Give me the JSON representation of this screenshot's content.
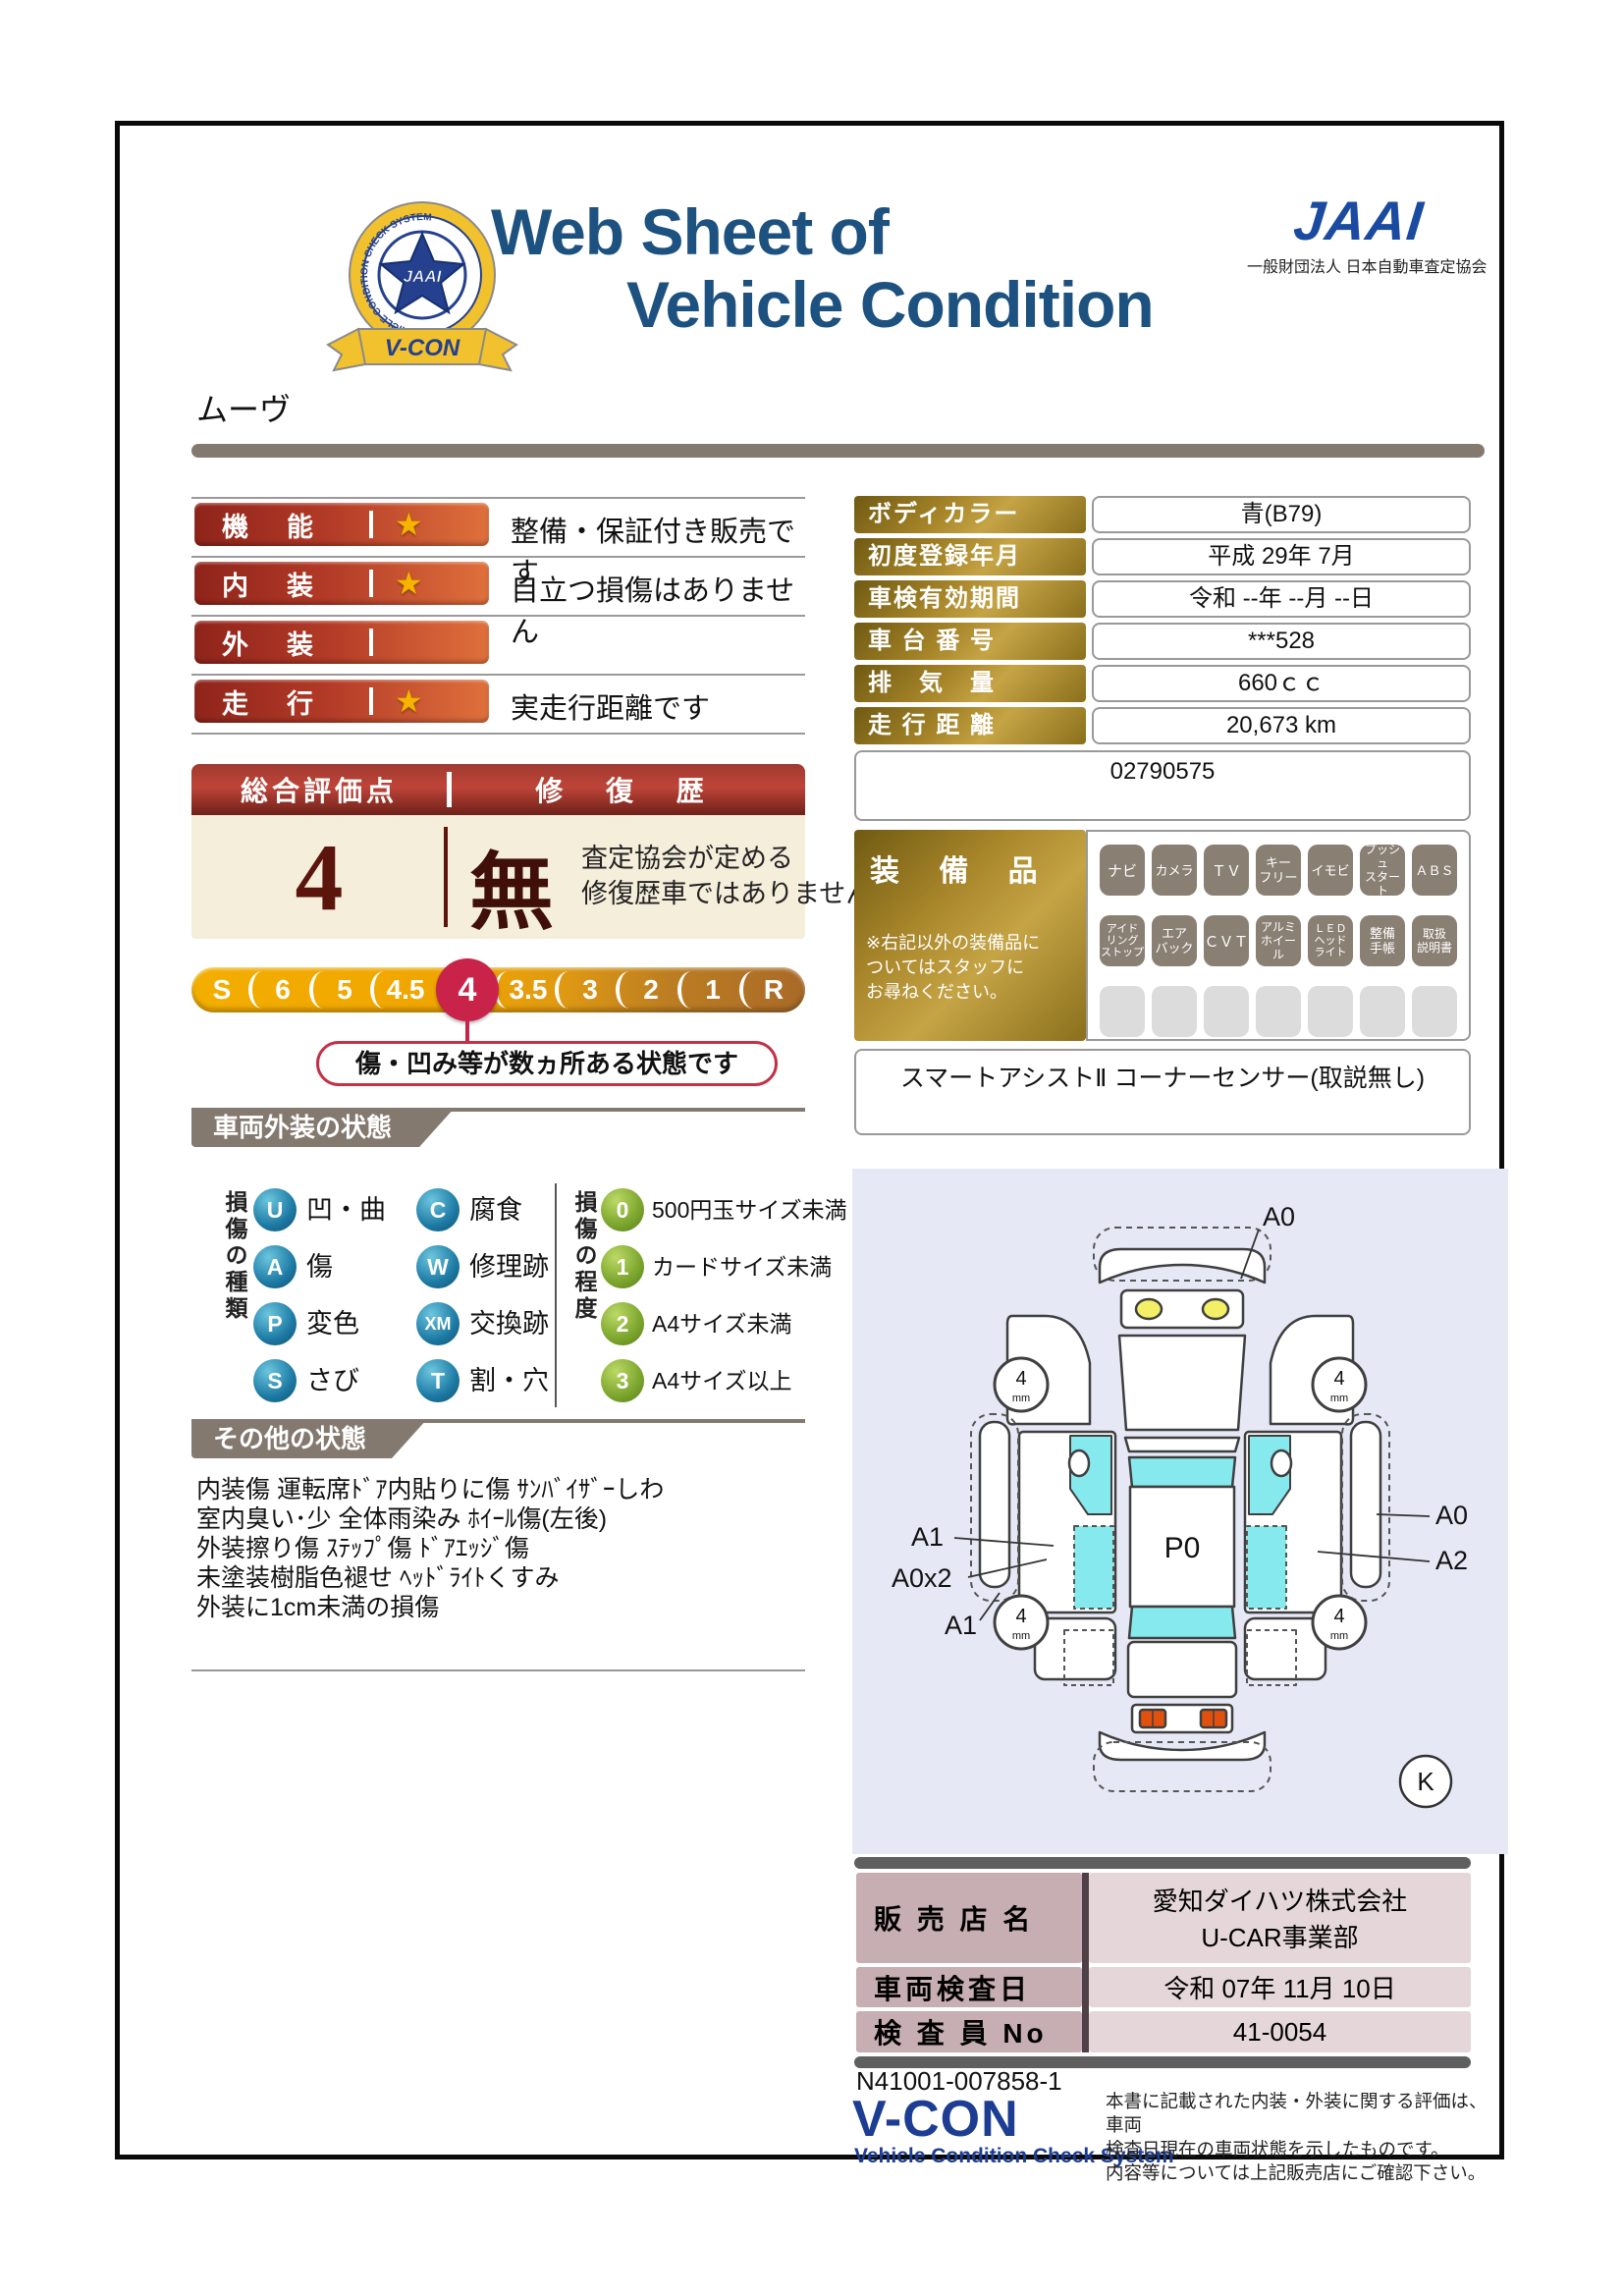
{
  "header": {
    "title_line1": "Web Sheet of",
    "title_line2": "Vehicle Condition",
    "jaai_logo": "JAAI",
    "jaai_subtitle": "一般財団法人 日本自動車査定協会",
    "emblem": {
      "center": "JAAI",
      "ring_text": "VEHICLE CONDITION CHECK SYSTEM",
      "ribbon": "V-CON"
    }
  },
  "vehicle_name": "ムーヴ",
  "ratings": {
    "star_icon": "★",
    "rows": [
      {
        "label": "機　能",
        "star": true,
        "comment": "整備・保証付き販売です"
      },
      {
        "label": "内　装",
        "star": true,
        "comment": "目立つ損傷はありません"
      },
      {
        "label": "外　装",
        "star": false,
        "comment": ""
      },
      {
        "label": "走　行",
        "star": true,
        "comment": "実走行距離です"
      }
    ]
  },
  "overall": {
    "header_left": "総合評価点",
    "header_right": "修 復 歴",
    "score": "4",
    "repair_flag": "無",
    "repair_note_line1": "査定協会が定める",
    "repair_note_line2": "修復歴車ではありません",
    "scale": [
      "S",
      "6",
      "5",
      "4.5",
      "4",
      "3.5",
      "3",
      "2",
      "1",
      "R"
    ],
    "selected": "4",
    "callout": "傷・凹み等が数ヵ所ある状態です"
  },
  "details": {
    "rows": [
      {
        "label": "ボディカラー",
        "value": "青(B79)"
      },
      {
        "label": "初度登録年月",
        "value": "平成 29年 7月"
      },
      {
        "label": "車検有効期間",
        "value": "令和 --年 --月 --日"
      },
      {
        "label": "車 台 番 号",
        "value": "***528"
      },
      {
        "label": "排　気　量",
        "value": "660ｃｃ"
      },
      {
        "label": "走 行 距 離",
        "value": "20,673 km"
      }
    ],
    "ref_number": "02790575"
  },
  "equipment": {
    "title": "装 備 品",
    "note": "※右記以外の装備品に\nついてはスタッフに\nお尋ねください。",
    "row1": [
      "ナビ",
      "カメラ",
      "ＴＶ",
      "キー\nフリー",
      "イモビ",
      "プッシュ\nスタート",
      "ＡＢＳ"
    ],
    "row2": [
      "アイド\nリング\nストップ",
      "エア\nバック",
      "ＣＶＴ",
      "アルミ\nホイール",
      "ＬＥＤ\nヘッド\nライト",
      "整備\n手帳",
      "取扱\n説明書"
    ],
    "extra": "スマートアシストⅡ コーナーセンサー(取説無し)"
  },
  "exterior": {
    "banner": "車両外装の状態",
    "type_label": "損傷の種類",
    "types": [
      {
        "code": "U",
        "label": "凹・曲"
      },
      {
        "code": "C",
        "label": "腐食"
      },
      {
        "code": "A",
        "label": "傷"
      },
      {
        "code": "W",
        "label": "修理跡"
      },
      {
        "code": "P",
        "label": "変色"
      },
      {
        "code": "XM",
        "label": "交換跡"
      },
      {
        "code": "S",
        "label": "さび"
      },
      {
        "code": "T",
        "label": "割・穴"
      }
    ],
    "degree_label": "損傷の程度",
    "degrees": [
      {
        "code": "0",
        "label": "500円玉サイズ未満"
      },
      {
        "code": "1",
        "label": "カードサイズ未満"
      },
      {
        "code": "2",
        "label": "A4サイズ未満"
      },
      {
        "code": "3",
        "label": "A4サイズ以上"
      }
    ]
  },
  "other": {
    "banner": "その他の状態",
    "lines": "内装傷 運転席ﾄﾞｱ内貼りに傷 ｻﾝﾊﾞｲｻﾞｰしわ\n室内臭い･少 全体雨染み ﾎｲｰﾙ傷(左後)\n外装擦り傷 ｽﾃｯﾌﾟ傷 ﾄﾞｱｴｯｼﾞ傷\n未塗装樹脂色褪せ ﾍｯﾄﾞﾗｲﾄくすみ\n外装に1cm未満の損傷"
  },
  "diagram": {
    "roof_label": "P0",
    "wheel_value": "4",
    "wheel_unit": "mm",
    "labels": {
      "front": "A0",
      "left_door": "A1",
      "left_lower": "A0x2",
      "left_rear": "A1",
      "right_strip": "A0",
      "right_door": "A2"
    },
    "corner_mark": "K"
  },
  "dealer": {
    "rows": [
      {
        "label": "販 売 店 名",
        "value": "愛知ダイハツ株式会社\nU-CAR事業部"
      },
      {
        "label": "車両検査日",
        "value": "令和 07年 11月 10日"
      },
      {
        "label": "検 査 員 No",
        "value": "41-0054"
      }
    ]
  },
  "footer": {
    "doc_number": "N41001-007858-1",
    "vcon_logo": "V-CON",
    "vcon_subtitle": "Vehicle Condition Check System",
    "disclaimer": "本書に記載された内装・外装に関する評価は、車両\n検査日現在の車両状態を示したものです。\n内容等については上記販売店にご確認下さい。"
  },
  "colors": {
    "navy_title": "#1d5280",
    "jaai_blue": "#1a4ba0",
    "bar_red": "#b23a27",
    "gold_label": "#a8862a",
    "scale_gold": "#f0a500",
    "selected_crimson": "#c9234a",
    "banner_taupe": "#84796f",
    "cream": "#f4eedb",
    "legend_blue": "#1d7aa4",
    "legend_green": "#79a32c",
    "dealer_mauve": "#c6aeb2",
    "vcon_navy": "#1d3d92",
    "diagram_bg": "#e7e8f5",
    "glass_cyan": "#86e9ee"
  }
}
